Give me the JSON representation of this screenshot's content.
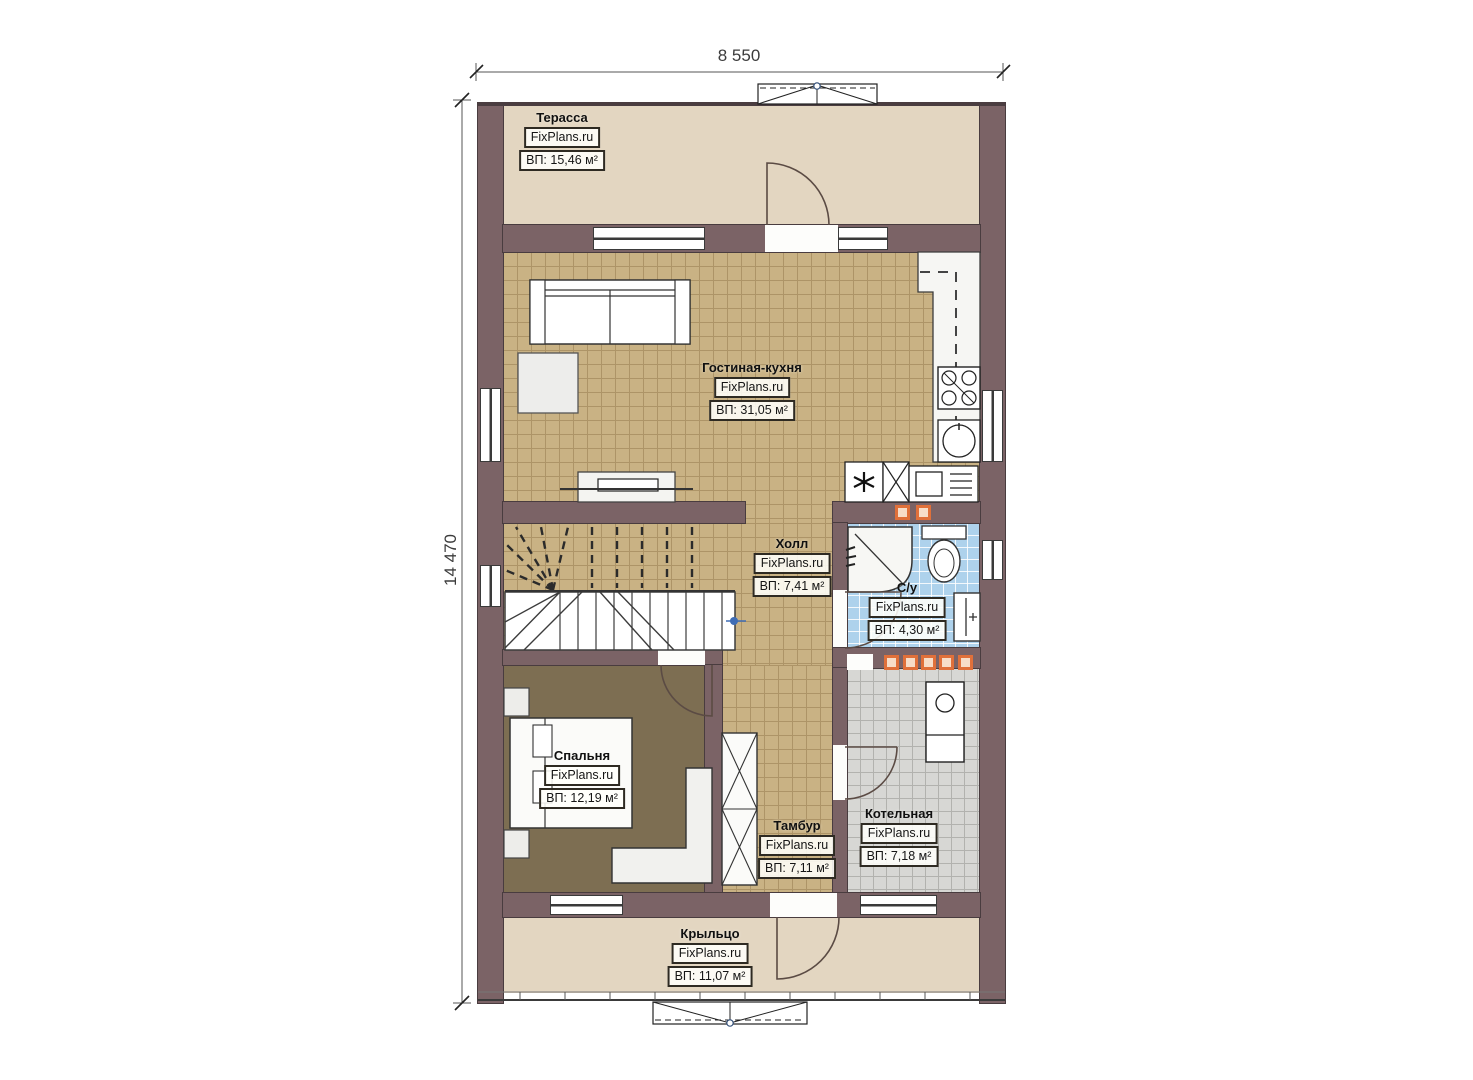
{
  "dimensions": {
    "width": "8 550",
    "height": "14 470"
  },
  "rooms": {
    "terrace": {
      "name": "Терасса",
      "brand": "FixPlans.ru",
      "area": "ВП: 15,46 м²"
    },
    "living_kitchen": {
      "name": "Гостиная-кухня",
      "brand": "FixPlans.ru",
      "area": "ВП: 31,05 м²"
    },
    "hall": {
      "name": "Холл",
      "brand": "FixPlans.ru",
      "area": "ВП: 7,41 м²"
    },
    "bathroom": {
      "name": "С/у",
      "brand": "FixPlans.ru",
      "area": "ВП: 4,30 м²"
    },
    "bedroom": {
      "name": "Спальня",
      "brand": "FixPlans.ru",
      "area": "ВП: 12,19 м²"
    },
    "vestibule": {
      "name": "Тамбур",
      "brand": "FixPlans.ru",
      "area": "ВП: 7,11 м²"
    },
    "boiler": {
      "name": "Котельная",
      "brand": "FixPlans.ru",
      "area": "ВП: 7,18 м²"
    },
    "porch": {
      "name": "Крыльцо",
      "brand": "FixPlans.ru",
      "area": "ВП: 11,07 м²"
    }
  },
  "colors": {
    "wall": "#7b6366",
    "tile_tan": "#c9b284",
    "tile_blue": "#aed2ec",
    "tile_gray": "#d7d7d4",
    "bedroom_floor": "#7d6e52",
    "deck": "#e3d6c1",
    "accent_orange": "#e0703a"
  }
}
